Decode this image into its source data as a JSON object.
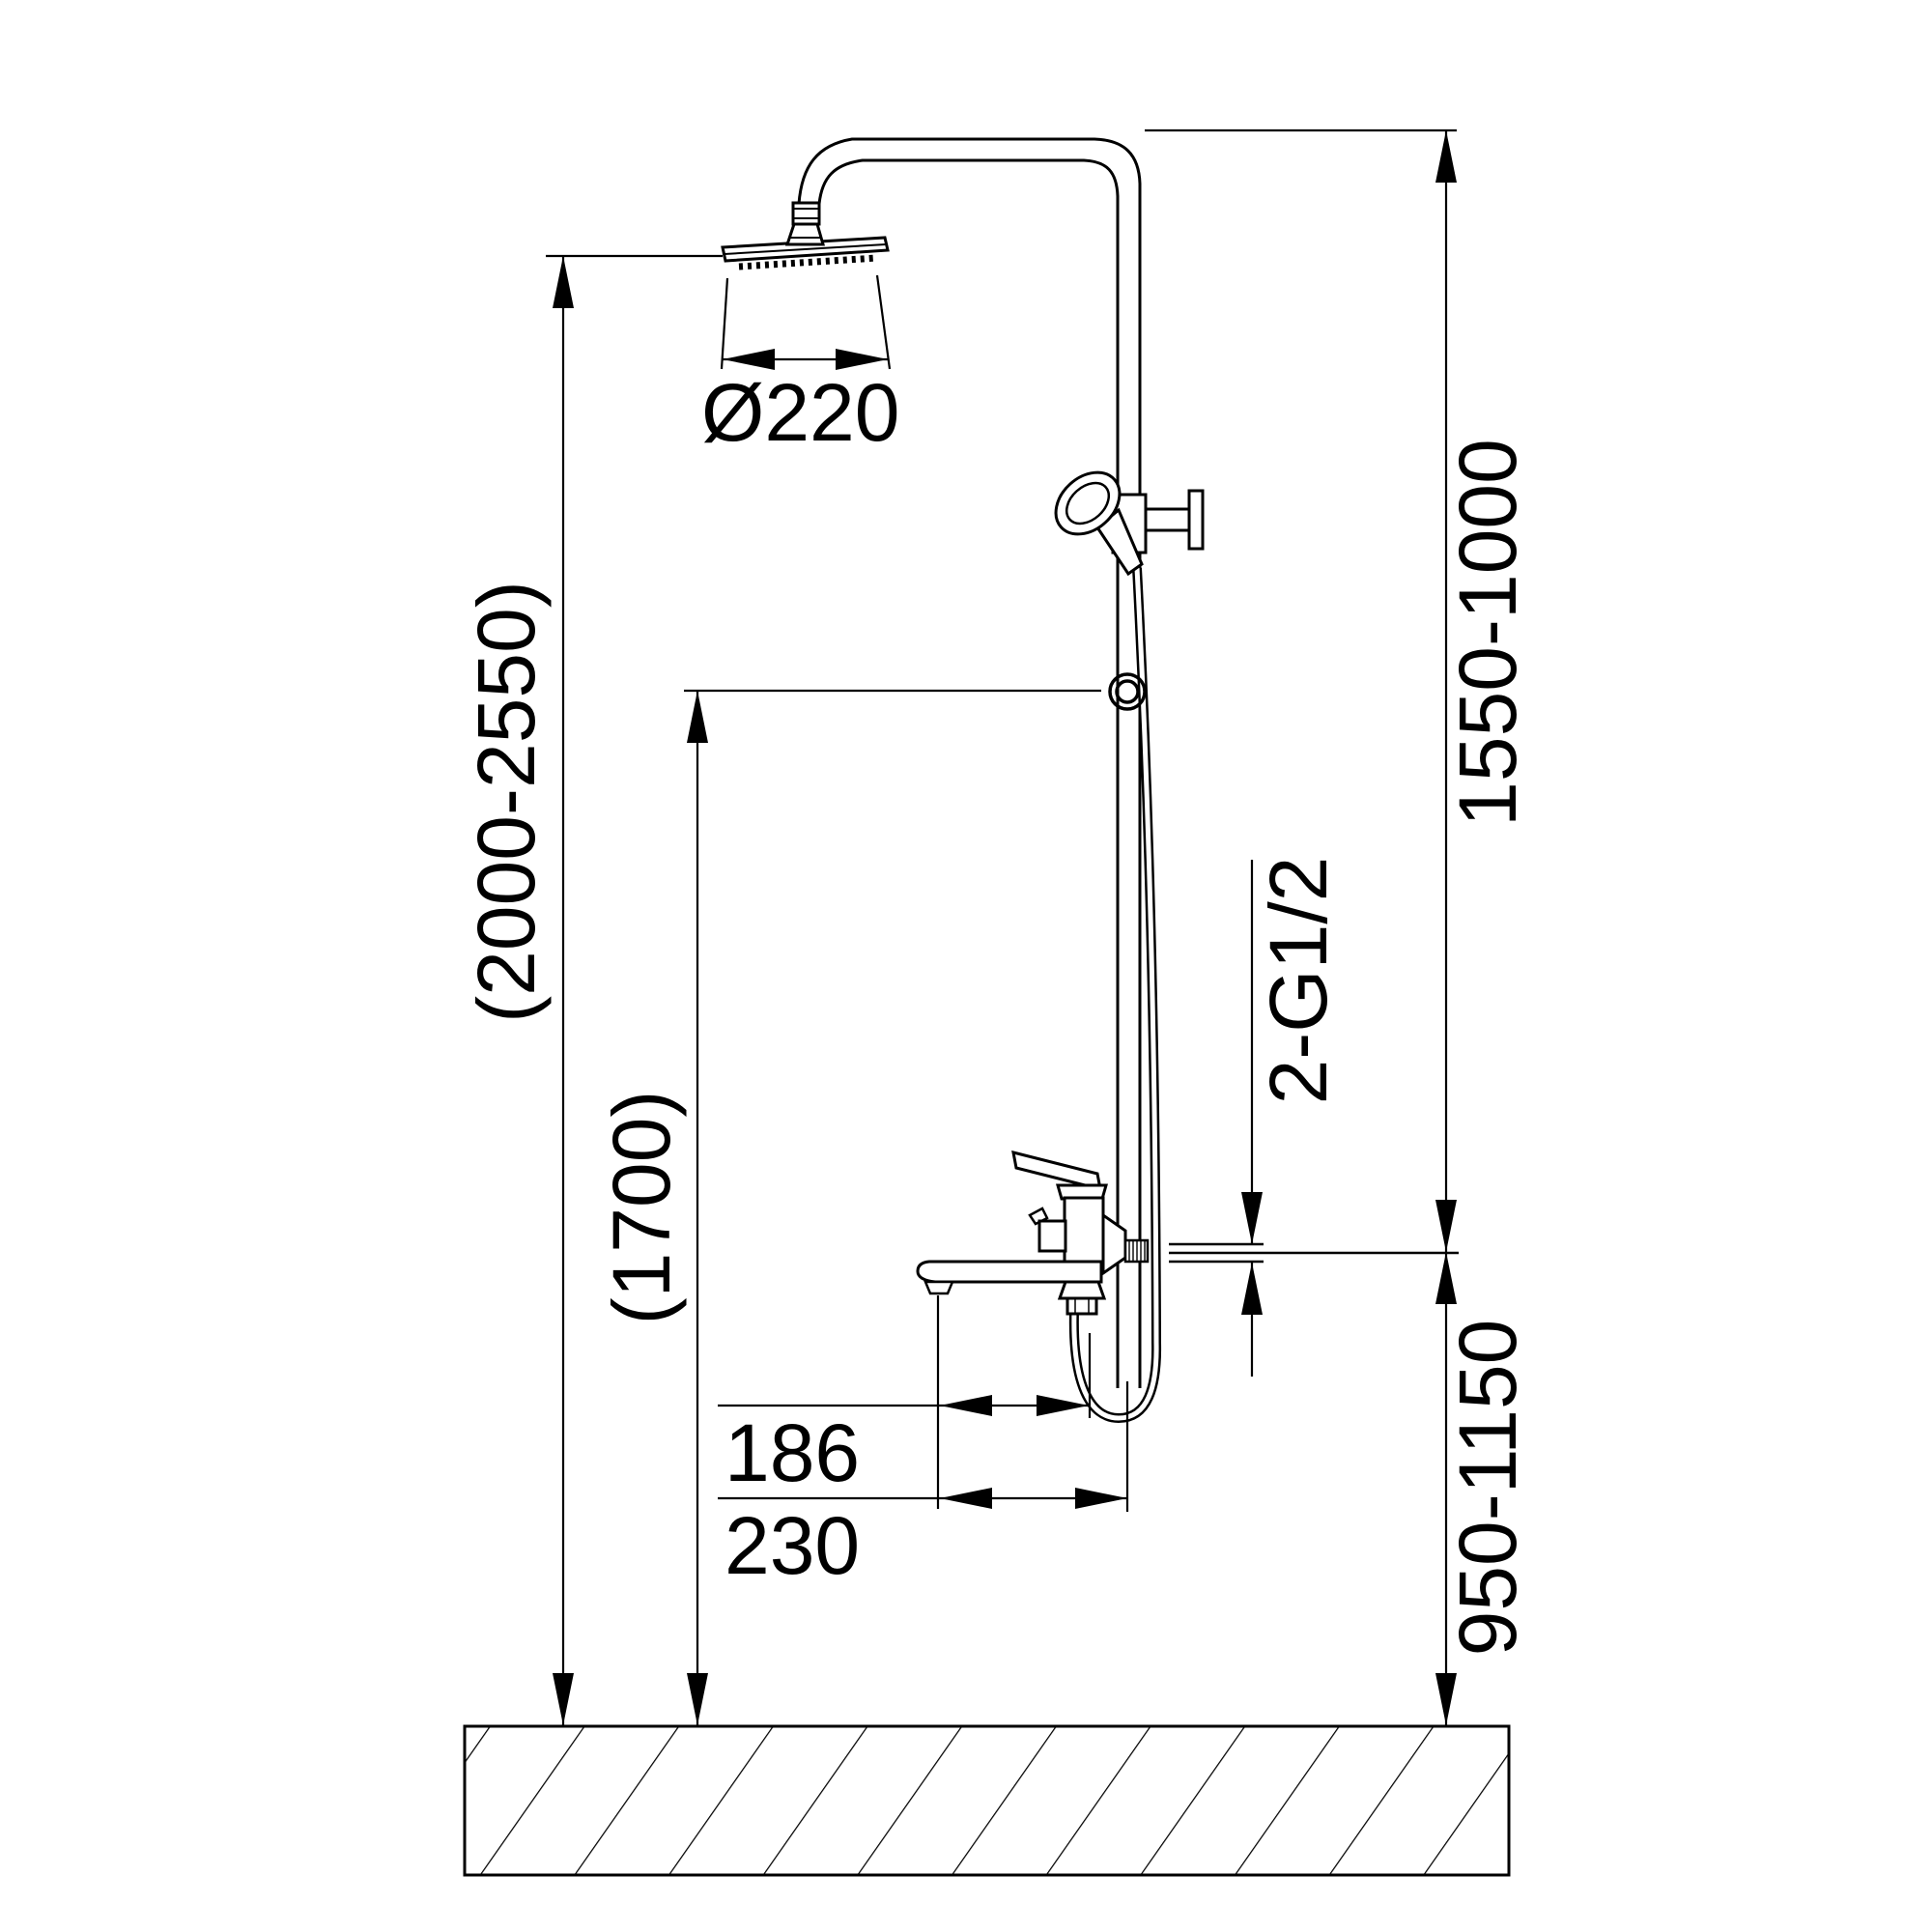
{
  "page": {
    "title": "Shower column set — installation dimension drawing",
    "background": "#ffffff"
  },
  "colors": {
    "line": "#000000",
    "text": "#000000"
  },
  "labels": {
    "head_diameter": "Ø220",
    "overall_height_range": "(2000-2550)",
    "hand_shower_height": "(1700)",
    "riser_adjust_range": "1550-1000",
    "mixer_install_height": "950-1150",
    "thread_connection": "2-G1/2",
    "spout_dim_inner": "186",
    "spout_dim_outer": "230"
  },
  "parts": [
    "rain-shower-head",
    "shower-arm-pipe",
    "riser-pipe",
    "hand-shower",
    "slider-holder-ring",
    "mixer-with-lever",
    "tub-spout",
    "shower-hose",
    "wall-connection",
    "floor"
  ]
}
